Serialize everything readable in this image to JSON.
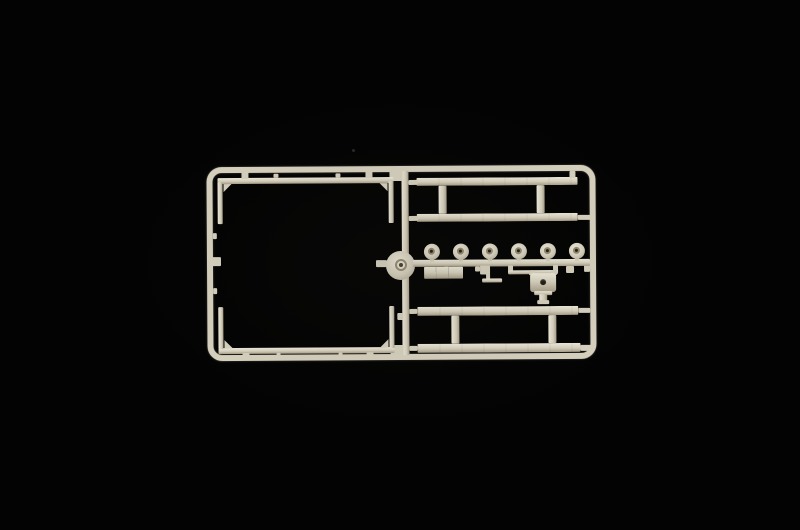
{
  "scene": {
    "type": "product-photo",
    "subject": "Unassembled injection-molded plastic model kit sprue (parts runner) of a truck trailer, photographed on a black background",
    "background_color": "#030303",
    "plastic": {
      "base": "#d6d0be",
      "highlight": "#eeead9",
      "shadow": "#a89f89",
      "deep_shadow": "#6f684f"
    },
    "sprue": {
      "outer_frame": "rounded rectangular runner frame",
      "central_runner": "vertical runner dividing left and right bays",
      "left_bay": {
        "parts": [
          "upper body channel rail with two corner posts",
          "lower body channel rail with two corner posts"
        ]
      },
      "center_part": "round turntable / hub disc with ringed center",
      "right_bay": {
        "top_chassis_assembly": {
          "rails": 2,
          "crossmembers": 2
        },
        "wheel_hubs": {
          "count": 6,
          "note": "round hubs with ringed center holes on a horizontal runner"
        },
        "small_parts": [
          "segmented rectangular block",
          "small step bracket",
          "fifth-wheel coupling plate with center hole and kingpin"
        ],
        "bottom_chassis_assembly": {
          "rails": 2,
          "crossmembers": 2
        }
      }
    }
  }
}
